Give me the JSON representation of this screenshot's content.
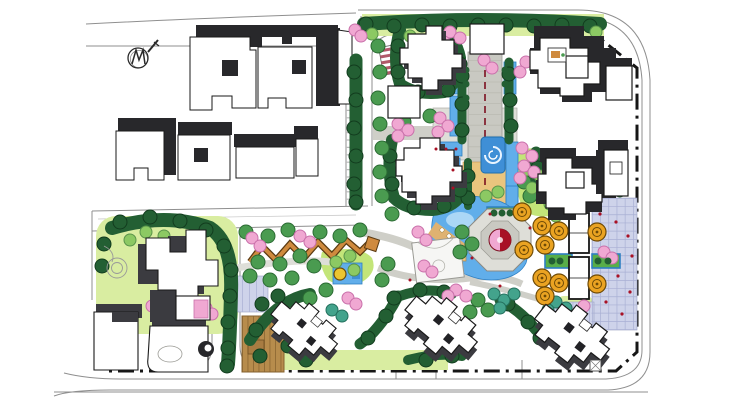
{
  "figure": {
    "kind": "landscape-masterplan-rendering",
    "features": [
      "context-buildings",
      "north-arrow",
      "perimeter-roads",
      "site-boundary-dashdot",
      "central-axis-promenade",
      "spiral-fountain",
      "reflecting-channels",
      "lake",
      "octagon-island-plaza",
      "orange-tree-bosque",
      "amenity-colonnade",
      "lavender-plaza",
      "zigzag-pergola-walk",
      "timber-deck",
      "sports-court",
      "residential-towers",
      "rotated-villas",
      "tree-ring",
      "parking-bays",
      "striped-ramp",
      "hedge-planters"
    ]
  },
  "palette": {
    "paper": "#ffffff",
    "outline": "#1a1a1a",
    "road": "#8f8f8f",
    "road_light": "#bcbcbc",
    "boundary": "#161616",
    "ctx_shadow": "#28282b",
    "bldg_shadow": "#3b3b40",
    "bldg_white": "#ffffff",
    "tree_dark": "#235f33",
    "tree_dark_stroke": "#123c1e",
    "tree_mid": "#4a9b50",
    "tree_mid_stroke": "#2b6b33",
    "tree_light": "#8cc963",
    "tree_light_stroke": "#5a944b",
    "lawn": "#d9eda1",
    "lawn_bright": "#c3e579",
    "pink": "#f0a8d2",
    "pink_stroke": "#c970aa",
    "teal": "#43a38c",
    "teal_stroke": "#23705d",
    "orange_tree": "#eaa322",
    "orange_stroke": "#6e4a06",
    "water": "#61aeea",
    "water_deep": "#3f8fd6",
    "water_light": "#abd7f6",
    "water_stroke": "#2e7fc2",
    "paving": "#cfcfc8",
    "paving_light": "#deded8",
    "axis_paving": "#c9c9c2",
    "tan": "#eac57e",
    "sand": "#dfb271",
    "lavender": "#ced3ea",
    "lavender_grid": "#a9b0d4",
    "wood": "#b78c4c",
    "wood_line": "#86622f",
    "pergola": "#cf8a3e",
    "pergola_dark": "#5a3a12",
    "red_accent": "#a81125",
    "stripe_red": "#b2596a",
    "axis_red": "#7c1020",
    "hedge": "#58ae49",
    "court": "#f6f6f4",
    "yellow": "#ecc530"
  }
}
